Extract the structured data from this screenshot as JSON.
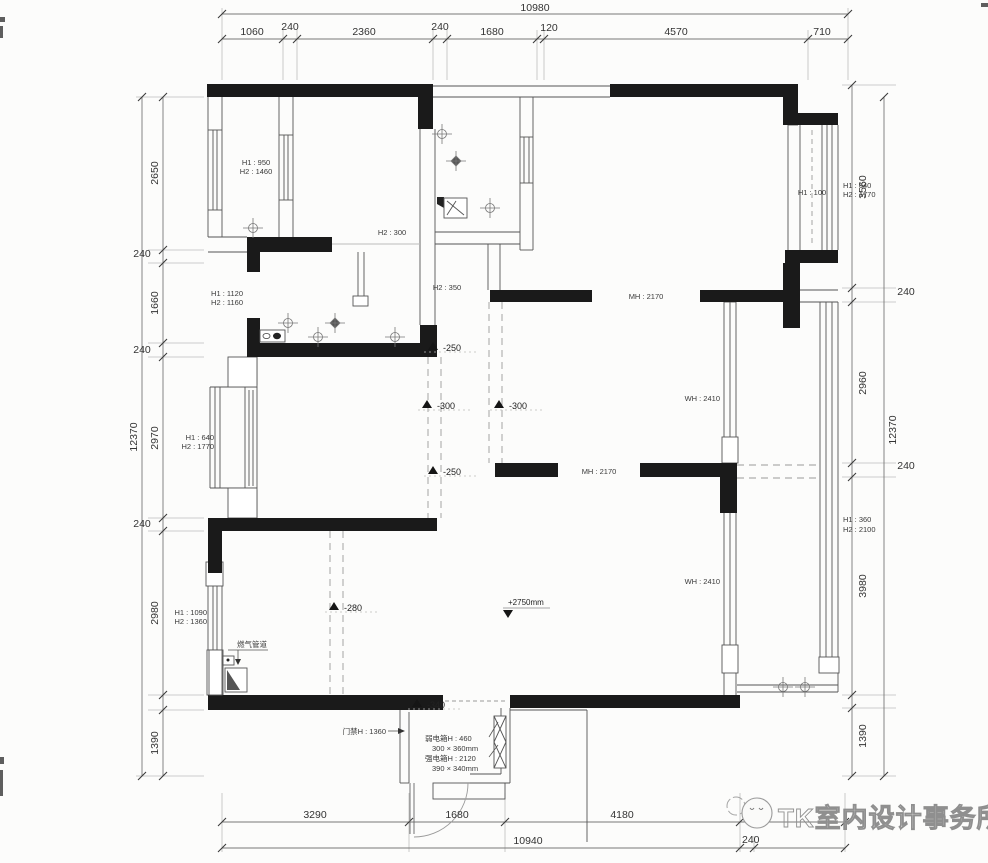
{
  "dims": {
    "top": {
      "overall": "10980",
      "seg_1060": "1060",
      "seg_240a": "240",
      "seg_2360": "2360",
      "seg_240b": "240",
      "seg_1680": "1680",
      "seg_120": "120",
      "seg_4570": "4570",
      "seg_710": "710"
    },
    "left": {
      "overall": "12370",
      "seg_2650": "2650",
      "seg_240a": "240",
      "seg_1660": "1660",
      "seg_240b": "240",
      "seg_2970": "2970",
      "seg_240c": "240",
      "seg_2980": "2980",
      "seg_1390": "1390"
    },
    "right": {
      "overall": "12370",
      "seg_3560": "3560",
      "seg_240a": "240",
      "seg_2960": "2960",
      "seg_240b": "240",
      "seg_3980": "3980",
      "seg_1390": "1390"
    },
    "bottom": {
      "overall": "10940",
      "seg_3290": "3290",
      "seg_1680": "1680",
      "seg_4180": "4180",
      "seg_240": "240"
    }
  },
  "annotations": {
    "window_tl_h1": "H1 : 950",
    "window_tl_h2": "H2 : 1460",
    "opening_h2_300": "H2 : 300",
    "bath_h1": "H1 : 1120",
    "bath_h2": "H2 : 1160",
    "opening_h2_350": "H2 : 350",
    "opening_mh_top": "MH : 2170",
    "bay_right_h1": "H1 : 100",
    "bay_right_out_h1": "H1 : 640",
    "bay_right_out_h2": "H2 : 1770",
    "bay_left_h1": "H1 : 640",
    "bay_left_h2": "H2 : 1770",
    "window_e1": "WH : 2410",
    "window_e2": "WH : 2410",
    "opening_mh_mid": "MH : 2170",
    "window_r_h1": "H1 : 360",
    "window_r_h2": "H2 : 2100",
    "window_bl_h1": "H1 : 1090",
    "window_bl_h2": "H2 : 1360",
    "gas_pipe": "燃气管道",
    "door_access": "门禁H : 1360",
    "weak_box_line1": "弱电箱H : 460",
    "weak_box_line2": "300 × 360mm",
    "strong_box_line1": "强电箱H : 2120",
    "strong_box_line2": "390 × 340mm"
  },
  "levels": {
    "l1": "-250",
    "l2": "-300",
    "l3": "-300",
    "l4": "-250",
    "l5": "-280",
    "l6": "-340",
    "ceiling": "+2750mm"
  },
  "logo": {
    "text": "TK室内设计事务所"
  }
}
